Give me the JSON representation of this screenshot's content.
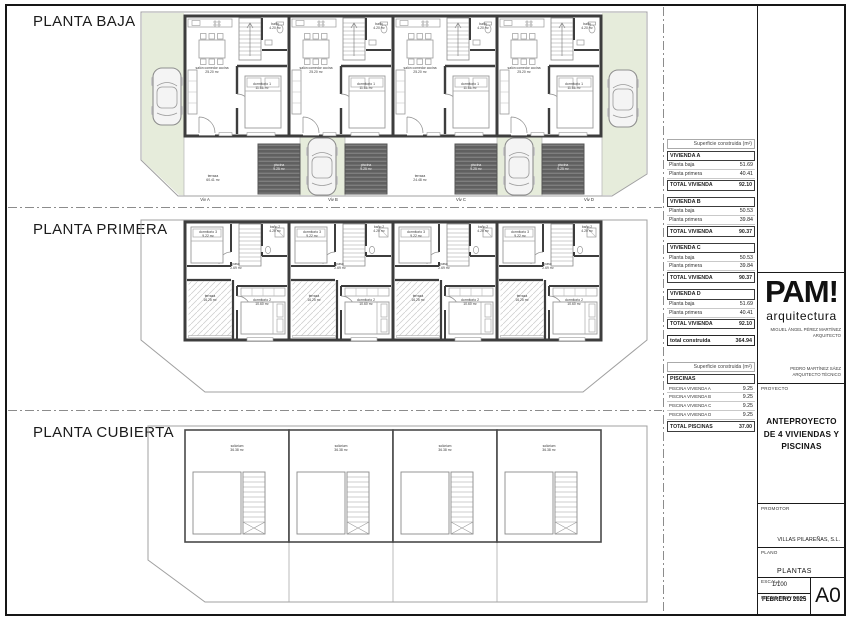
{
  "plans": {
    "baja": {
      "title": "PLANTA BAJA",
      "rooms": {
        "salon": "salón comedor cocina",
        "salon_area": "25.20 m²",
        "dormitorio1": "dormitorio 1",
        "dormitorio1_area": "11.86 m²",
        "bano": "baño",
        "bano_area": "4.20 m²",
        "terraza": "terraza",
        "terraza_area": "60.41 m²",
        "terraza2_area": "24.48 m²",
        "piscina": "piscina",
        "piscina_area": "9.25 m²",
        "viviendas": [
          "Viv A",
          "Viv B",
          "Viv C",
          "Viv D"
        ]
      }
    },
    "primera": {
      "title": "PLANTA PRIMERA",
      "rooms": {
        "dormitorio2": "dormitorio 2",
        "dormitorio2_area": "10.60 m²",
        "dormitorio3": "dormitorio 3",
        "dormitorio3_area": "9.22 m²",
        "bano2": "baño 2",
        "bano2_area": "4.20 m²",
        "paso": "paso",
        "paso_area": "2.69 m²",
        "terraza": "terraza",
        "terraza_area": "16.25 m²"
      }
    },
    "cubierta": {
      "title": "PLANTA CUBIERTA",
      "rooms": {
        "solarium": "solárium",
        "solarium_area": "36.38 m²"
      }
    }
  },
  "tables": {
    "header": "Superficie construida (m²)",
    "viviendas": [
      {
        "name": "VIVIENDA A",
        "rows": [
          [
            "Planta baja",
            "51.69"
          ],
          [
            "Planta primera",
            "40.41"
          ]
        ],
        "total_label": "TOTAL VIVIENDA",
        "total": "92.10"
      },
      {
        "name": "VIVIENDA B",
        "rows": [
          [
            "Planta baja",
            "50.53"
          ],
          [
            "Planta primera",
            "39.84"
          ]
        ],
        "total_label": "TOTAL VIVIENDA",
        "total": "90.37"
      },
      {
        "name": "VIVIENDA C",
        "rows": [
          [
            "Planta baja",
            "50.53"
          ],
          [
            "Planta primera",
            "39.84"
          ]
        ],
        "total_label": "TOTAL VIVIENDA",
        "total": "90.37"
      },
      {
        "name": "VIVIENDA D",
        "rows": [
          [
            "Planta baja",
            "51.69"
          ],
          [
            "Planta primera",
            "40.41"
          ]
        ],
        "total_label": "TOTAL VIVIENDA",
        "total": "92.10"
      }
    ],
    "grand_label": "total construida",
    "grand_value": "364.94",
    "piscinas": {
      "name": "PISCINAS",
      "rows": [
        [
          "PISCINA VIVIENDA A",
          "9.25"
        ],
        [
          "PISCINA VIVIENDA B",
          "9.25"
        ],
        [
          "PISCINA VIVIENDA C",
          "9.25"
        ],
        [
          "PISCINA VIVIENDA D",
          "9.25"
        ]
      ],
      "total_label": "TOTAL PISCINAS",
      "total": "37.00"
    }
  },
  "titleblock": {
    "logo": "PAM!",
    "logo_sub": "arquitectura",
    "architect": "MIGUEL ÁNGEL PÉREZ MARTÍNEZ",
    "architect_role": "ARQUITECTO",
    "technical": "PEDRO MARTÍNEZ SÁEZ",
    "technical_role": "ARQUITECTO TÉCNICO",
    "proyecto_label": "PROYECTO",
    "proyecto": "ANTEPROYECTO DE 4 VIVIENDAS Y PISCINAS",
    "promotor_label": "PROMOTOR",
    "promotor": "VILLAS PILAREÑAS, S.L.",
    "plano_label": "PLANO",
    "plano": "PLANTAS",
    "escala_label": "ESCALA",
    "escala": "1/100",
    "fecha_label": "FECHA PROYECTO",
    "fecha": "FEBRERO 2025",
    "formato": "A0"
  },
  "colors": {
    "green": "#e6ecdb",
    "pool": "#606060",
    "wall": "#3d3d3d"
  }
}
